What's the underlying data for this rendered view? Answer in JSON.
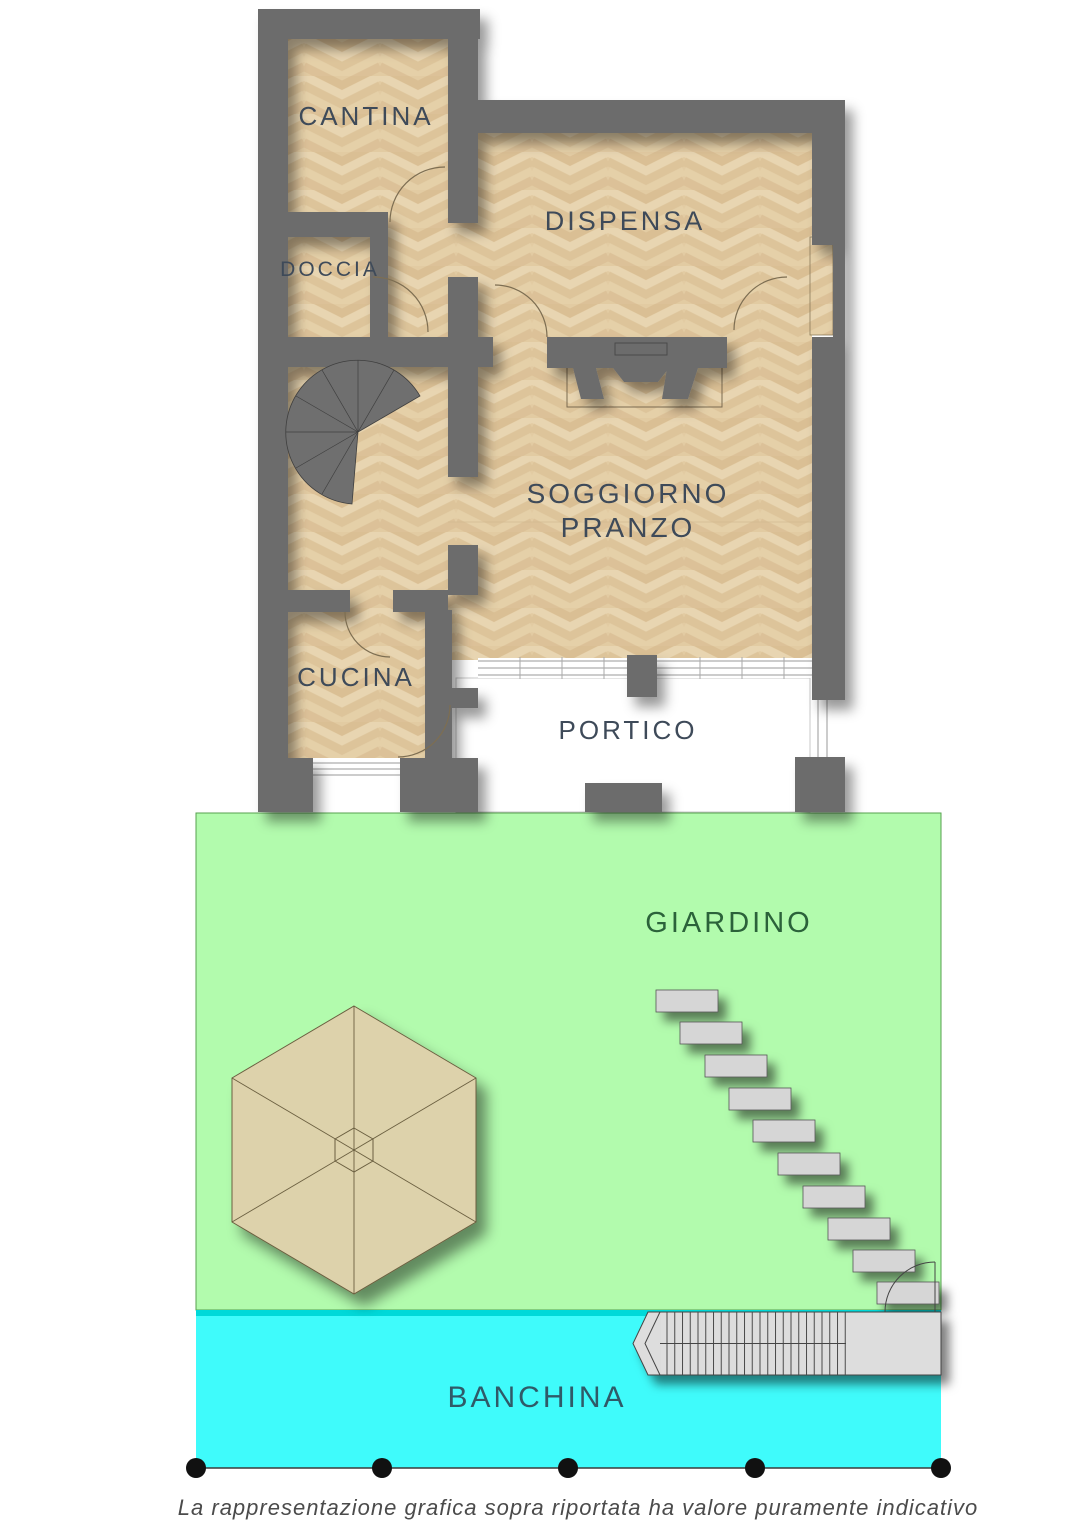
{
  "labels": {
    "cantina": "CANTINA",
    "doccia": "DOCCIA",
    "dispensa": "DISPENSA",
    "soggiorno_line1": "SOGGIORNO",
    "soggiorno_line2": "PRANZO",
    "cucina": "CUCINA",
    "portico": "PORTICO",
    "giardino": "GIARDINO",
    "banchina": "BANCHINA"
  },
  "footer": {
    "disclaimer": "La rappresentazione grafica sopra riportata ha valore puramente indicativo"
  },
  "colors": {
    "wall": "#6c6c6c",
    "parquet_base": "#e2cba2",
    "garden": "#b2fbad",
    "garden_border": "#57a24f",
    "water": "#3ffbfb",
    "water_edge": "#00d9d9",
    "stone": "#d6d6d6",
    "dock": "#dddddd",
    "umbrella": "#ddd2ab",
    "room_label": "#3e4a59",
    "giardino_label": "#2b623a",
    "banchina_label": "#2f5a68",
    "disclaimer": "#4b4b4b"
  }
}
